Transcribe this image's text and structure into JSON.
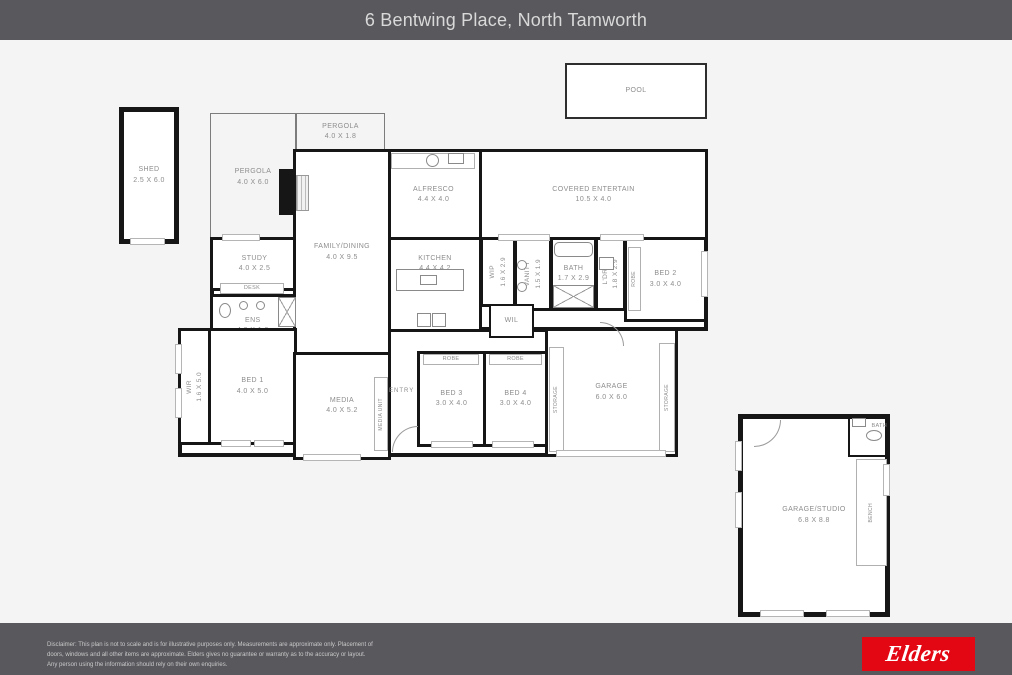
{
  "header": {
    "title": "6 Bentwing Place, North Tamworth"
  },
  "rooms": {
    "pool": {
      "name": "POOL"
    },
    "shed": {
      "name": "SHED",
      "dims": "2.5 X 6.0"
    },
    "pergola_left": {
      "name": "PERGOLA",
      "dims": "4.0 X 6.0"
    },
    "pergola_top": {
      "name": "PERGOLA",
      "dims": "4.0 X 1.8"
    },
    "alfresco": {
      "name": "ALFRESCO",
      "dims": "4.4 X 4.0"
    },
    "covered_entertain": {
      "name": "COVERED ENTERTAIN",
      "dims": "10.5 X 4.0"
    },
    "study": {
      "name": "STUDY",
      "dims": "4.0 X 2.5"
    },
    "desk": {
      "name": "DESK"
    },
    "ens": {
      "name": "ENS",
      "dims": "4.0 X 1.6"
    },
    "family_dining": {
      "name": "FAMILY/DINING",
      "dims": "4.0 X 9.5"
    },
    "kitchen": {
      "name": "KITCHEN",
      "dims": "4.4 X 4.2"
    },
    "wip": {
      "name": "WIP",
      "dims": "1.6 X 2.9"
    },
    "vanity": {
      "name": "VANITY",
      "dims": "1.5 X 1.9"
    },
    "bath": {
      "name": "BATH",
      "dims": "1.7 X 2.9"
    },
    "ldry": {
      "name": "L'DRY",
      "dims": "1.8 X 2.9"
    },
    "bed2": {
      "name": "BED 2",
      "dims": "3.0 X 4.0"
    },
    "wil": {
      "name": "WIL"
    },
    "wir": {
      "name": "WIR",
      "dims": "1.6 X 5.0"
    },
    "bed1": {
      "name": "BED 1",
      "dims": "4.0 X 5.0"
    },
    "media": {
      "name": "MEDIA",
      "dims": "4.0 X 5.2"
    },
    "media_unit": {
      "name": "MEDIA UNIT"
    },
    "entry": {
      "name": "ENTRY"
    },
    "bed3": {
      "name": "BED 3",
      "dims": "3.0 X 4.0"
    },
    "bed4": {
      "name": "BED 4",
      "dims": "3.0 X 4.0"
    },
    "robe": {
      "name": "ROBE"
    },
    "storage": {
      "name": "STORAGE"
    },
    "garage": {
      "name": "GARAGE",
      "dims": "6.0 X 6.0"
    },
    "garage_studio": {
      "name": "GARAGE/STUDIO",
      "dims": "6.8 X 8.8"
    },
    "bath2": {
      "name": "BATH"
    },
    "bench": {
      "name": "BENCH"
    }
  },
  "footer": {
    "disclaimer": [
      "Disclaimer: This plan is not to scale and is for illustrative purposes only. Measurements are approximate only. Placement of",
      "doors, windows and all other items are approximate. Elders gives no guarantee or warranty as to the accuracy or layout.",
      "Any person using the information should rely on their own enquiries."
    ],
    "logo": "Elders"
  },
  "colors": {
    "header_bg": "#59585d",
    "plan_bg": "#f4f4f4",
    "wall": "#161616",
    "label": "#8d8d8d",
    "elders_red": "#e30613"
  }
}
